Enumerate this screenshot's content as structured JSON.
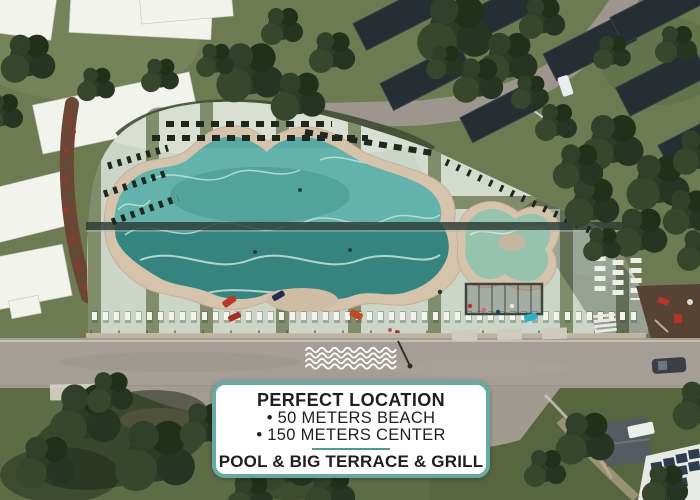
{
  "card": {
    "title": "PERFECT LOCATION",
    "lines": [
      "• 50 METERS BEACH",
      "• 150 METERS CENTER"
    ],
    "footer": "POOL & BIG TERRACE & GRILL",
    "colors": {
      "border": "#66a9a5",
      "background": "#ffffff",
      "text": "#1f1f1f",
      "divider": "#4f9a94"
    }
  },
  "decorations": {
    "waves_icon": {
      "color": "#ffffff",
      "line_count": 4
    }
  },
  "scene": {
    "type": "aerial-photo",
    "palette": {
      "pool_water": "#4aa5a1",
      "pool_water_deep": "#2e7b77",
      "kids_pool_water": "#96c3ae",
      "sand_edge": "#d5c3ac",
      "sun_deck": "#ccd6c8",
      "deck_stripe": "#7b8663",
      "grass": "#6e7a52",
      "trees": "#2e3c26",
      "road": "#a49e96",
      "cabin_roof_white": "#f3f3ee",
      "cabin_roof_dark": "#262e33"
    }
  }
}
